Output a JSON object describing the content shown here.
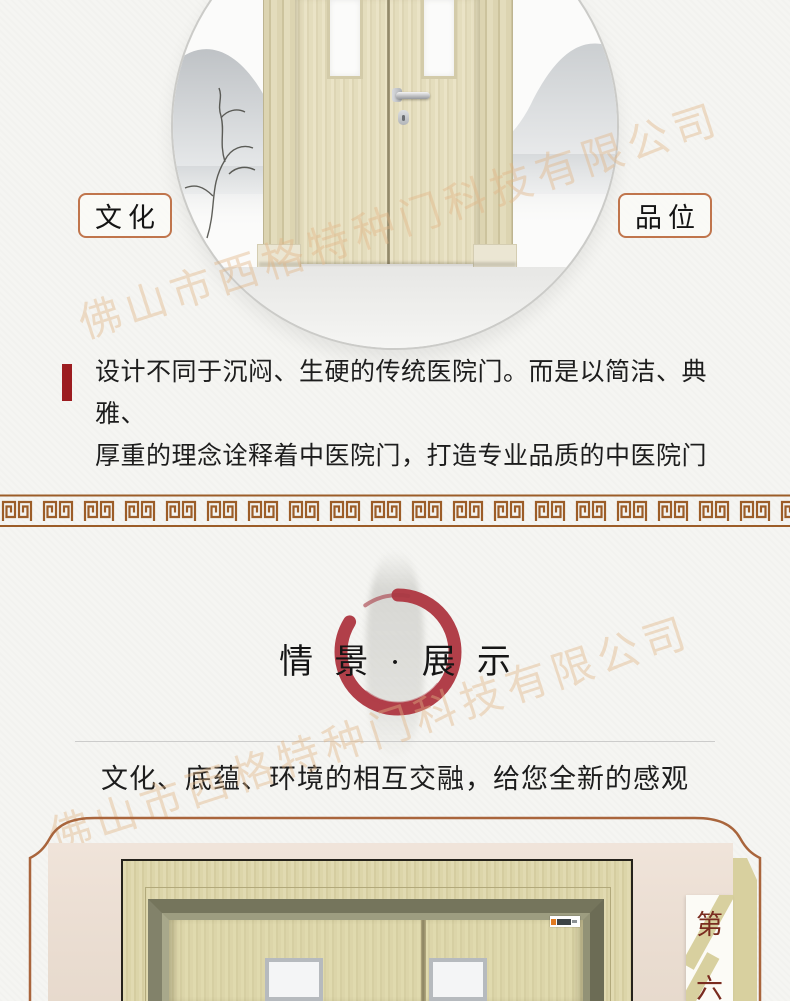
{
  "watermark": {
    "text": "佛山市西格特种门科技有限公司",
    "color": "#e2b585"
  },
  "hero": {
    "image_alt": "double-wooden-hospital-door-in-ink-landscape-circle",
    "left_badge": "文化",
    "right_badge": "品位"
  },
  "intro": {
    "accent_color": "#9c1c20",
    "line1": "设计不同于沉闷、生硬的传统医院门。而是以简洁、典雅、",
    "line2": "厚重的理念诠释着中医院门，打造专业品质的中医院门"
  },
  "divider": {
    "style": "greek-key-meander",
    "color": "#9c5d28"
  },
  "showcase": {
    "title": "情景·展示",
    "subtitle": "文化、底蕴、环境的相互交融，给您全新的感观",
    "enso_color": "#b13f49"
  },
  "gallery": {
    "frame_color": "#a9653c",
    "ribbon_color": "#d8d09f",
    "tag_top": "第",
    "tag_bottom": "六",
    "tag_text_color": "#7a2c20",
    "photo_alt": "double-wooden-door-with-frame-photo"
  }
}
